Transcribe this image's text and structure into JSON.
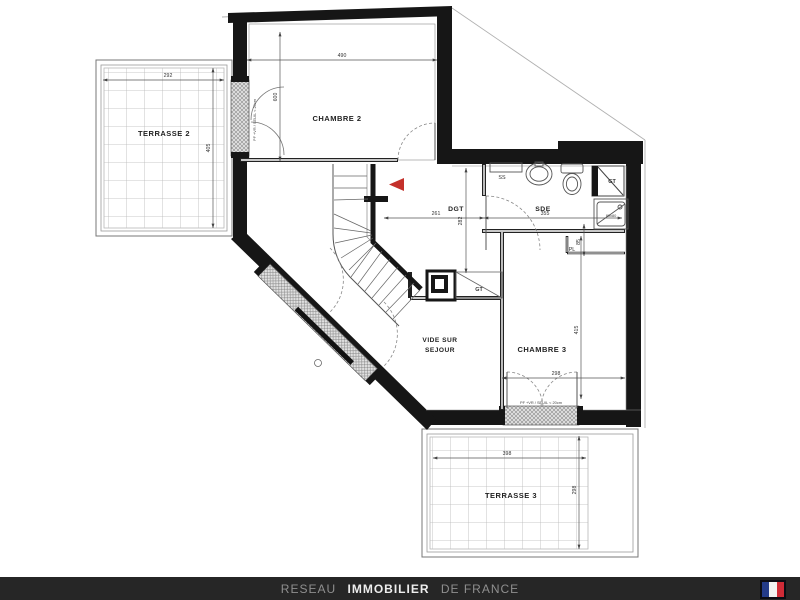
{
  "plan": {
    "rooms": {
      "terrasse2": {
        "name": "TERRASSE 2",
        "dim_width": "292",
        "dim_height": "405"
      },
      "chambre2": {
        "name": "CHAMBRE 2",
        "dim_width": "490",
        "dim_height": "600"
      },
      "dgt": {
        "name": "DGT",
        "dim_width": "261",
        "dim_depth": "282"
      },
      "sde": {
        "name": "SDE",
        "dim_width": "355"
      },
      "placard": {
        "name": "PL",
        "dim_width": "85"
      },
      "chambre3": {
        "name": "CHAMBRE 3",
        "dim_width": "298",
        "dim_height": "415"
      },
      "vide_sur_sejour": {
        "name_line1": "VIDE SUR",
        "name_line2": "SEJOUR"
      },
      "terrasse3": {
        "name": "TERRASSE 3",
        "dim_width": "398",
        "dim_height": "298"
      }
    },
    "annotations": {
      "duct_top_right": "GT",
      "duct_center": "GT",
      "towel_rail": "SS",
      "shower_size": "80x80",
      "door_spec_terrace3": "PF +VR / SEUIL < 20cm",
      "door_spec_terrace2": "PF +VR / SEUIL < 20cm"
    },
    "colors": {
      "wall": "#161616",
      "stair_arrow_red": "#c4312b"
    }
  },
  "footer": {
    "network_prefix": "RESEAU",
    "network_brand": "IMMOBILIER",
    "network_suffix": "DE FRANCE",
    "flag_blue": "#243b8a",
    "flag_white": "#f2f2f2",
    "flag_red": "#cf2b37"
  }
}
